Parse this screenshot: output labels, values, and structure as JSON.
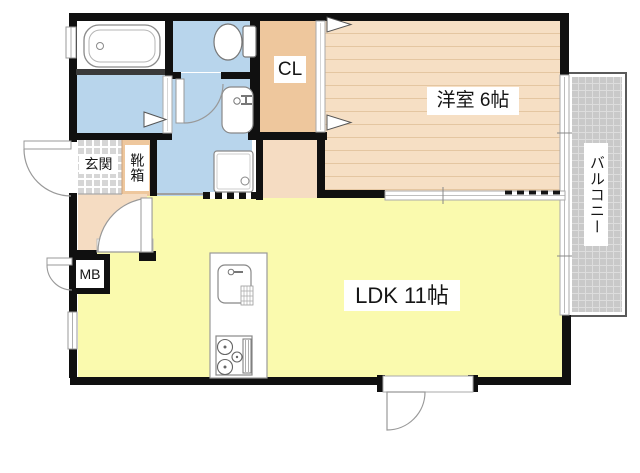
{
  "floorplan": {
    "type": "japanese-apartment-floorplan",
    "labels": {
      "closet": "CL",
      "western_room": "洋室 6帖",
      "balcony": "バルコニー",
      "entrance": "玄関",
      "shoe_cabinet": "靴箱",
      "meter_box": "MB",
      "ldk": "LDK 11帖"
    },
    "rooms": [
      {
        "name": "western_room",
        "size_tatami": "6帖"
      },
      {
        "name": "ldk",
        "size_tatami": "11帖"
      },
      {
        "name": "closet"
      },
      {
        "name": "balcony"
      },
      {
        "name": "entrance"
      },
      {
        "name": "shoe_cabinet"
      },
      {
        "name": "meter_box"
      },
      {
        "name": "bathroom"
      },
      {
        "name": "washroom"
      },
      {
        "name": "toilet"
      }
    ],
    "colors": {
      "wall": "#101010",
      "water_area_blue": "#b8d5ec",
      "closet_tan": "#eec79d",
      "wood_floor": "#f6dfc4",
      "wood_floor_line": "#e4c6a1",
      "hallway_peach": "#f5dcc2",
      "ldk_yellow": "#fafaae",
      "balcony_gray": "#c9c9c9",
      "entrance_tile_gray": "#d6d6d6"
    }
  }
}
